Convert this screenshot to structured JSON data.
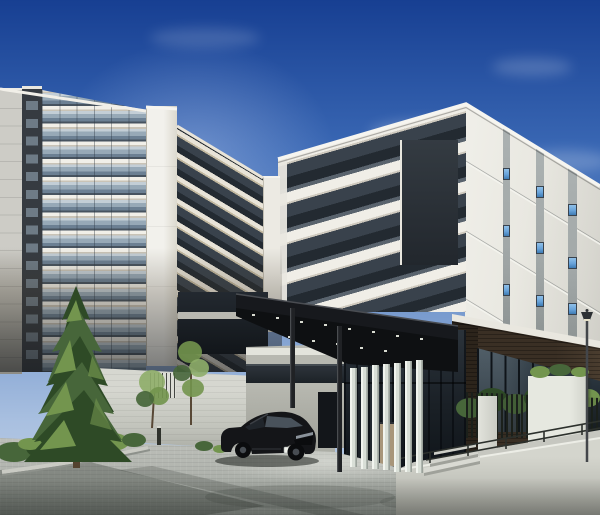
{
  "scene": {
    "type": "architectural-rendering",
    "description": "Daytime exterior CG rendering of a modern condominium complex: a white high-rise tower with glass-balustrade balconies on the left, a lower white residential wing on the right with vertical gray window stripes and small blue windows, a dark flat entrance canopy with downlights and slim columns, seven frosted-glass louver fins at the entrance, dark storefront glazing over a brown brick base, a street lamp, a black fastback sedan parked on gray paver driveway, a large evergreen tree with planting bed, young saplings, low concrete boundary walls, white screen panels, a black picket fence with shrubs, a ramp with metal handrail, all under a deep blue gradient sky with faint clouds.",
    "elements": [
      "sky",
      "clouds",
      "high-rise-tower",
      "tower-core-slab",
      "residential-wing",
      "window-stripes",
      "entrance-canopy",
      "canopy-downlights",
      "canopy-columns",
      "louver-fins",
      "lobby-glazing",
      "brick-base",
      "storefront-glass",
      "street-lamp",
      "boundary-wall",
      "wall-opening",
      "picket-fence",
      "screen-panels",
      "handrail",
      "ramp",
      "steps",
      "paved-driveway",
      "conifer-tree",
      "sapling-trees",
      "shrub-bed",
      "black-sedan",
      "license-plate",
      "sign-plate",
      "bollard"
    ]
  },
  "colors": {
    "sky_top": "#173f92",
    "sky_mid": "#3b69b5",
    "sky_low": "#7296cc",
    "sky_horizon": "#a9c0e0",
    "slab_hi": "#f1efe8",
    "slab_sh": "#c9c3b6",
    "tan": "#c2b89f",
    "glass_hi": "#c3ced6",
    "glass_mid": "#97a9b7",
    "glass_lo": "#6c8093",
    "glass_dk": "#47535f",
    "win_lite": "#6e7b86",
    "tower_side": "#cdccc6",
    "tower_dark": "#363b41",
    "core_white": "#f2f1ec",
    "core_shade": "#dcd9ce",
    "band_dk1": "#39424c",
    "band_dk2": "#232a31",
    "sw_white": "#e9e7e0",
    "se_white": "#e9e8e1",
    "stripe": "#a2a8a8",
    "window_blue": "#68a3da",
    "brick": "#3a2f24",
    "brick_dark": "#2c241b",
    "cornice": "#e9e7df",
    "glass_store": "#27313a",
    "glass_frame": "#0f1419",
    "canopy": "#17191d",
    "canopy_edge": "#4a4d52",
    "canopy_under": "#0e1012",
    "light_dot": "#d8dbd1",
    "fin_hi": "#f1f4ee",
    "fin_mid": "#d9dfd7",
    "fin_dk": "#aeb5ae",
    "wall": "#d6d7d0",
    "wall_top": "#e9eae3",
    "side_wall": "#b7b8b0",
    "paving": "#b4b7b1",
    "ramp": "#c3c4bc",
    "fence": "#1b201b",
    "green_dk": "#2e4a26",
    "green_md": "#47663a",
    "green_hi": "#73954e",
    "green_lite": "#8fae6a",
    "trunk": "#54432f",
    "car_body": "#141518",
    "car_glass": "#49525b",
    "car_dark": "#0b0c0e",
    "car_trim": "#8b939b",
    "plate": "#eef0ea",
    "lamp": "#43464a"
  }
}
